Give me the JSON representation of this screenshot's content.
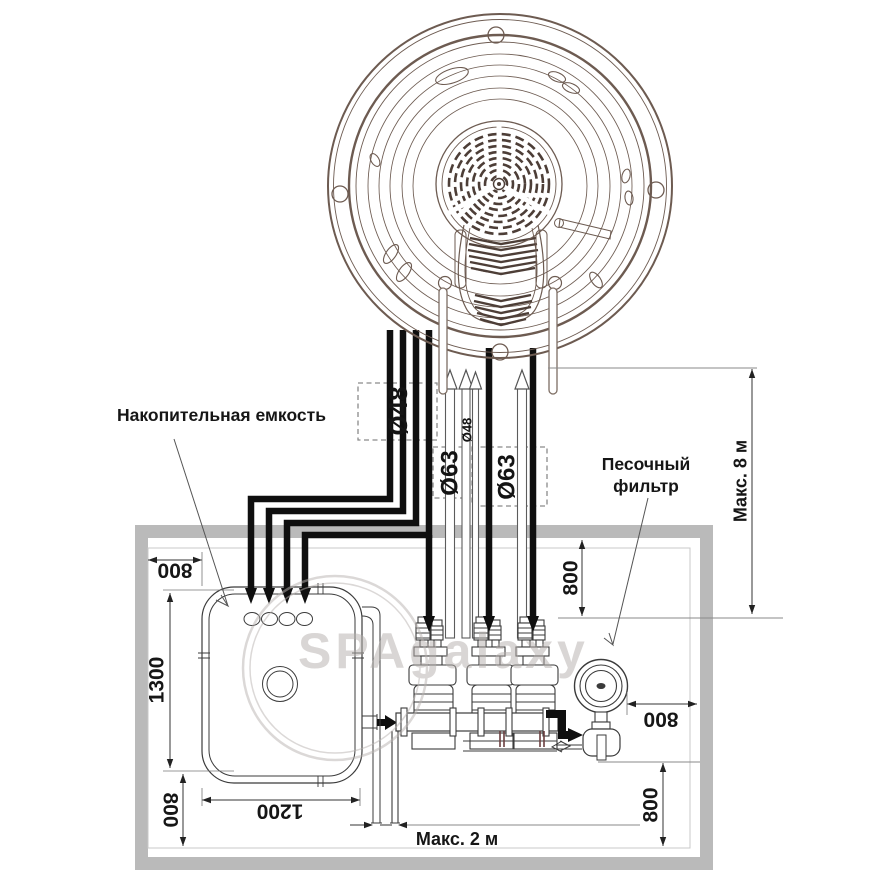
{
  "watermark": {
    "text": "SPAgalaxy"
  },
  "labels": {
    "storage_tank": "Накопительная емкость",
    "sand_filter_line1": "Песочный",
    "sand_filter_line2": "фильтр",
    "max_8m": "Макс. 8 м",
    "max_2m": "Макс. 2 м"
  },
  "pipes": {
    "d48_main": "Ø48",
    "d48_small": "Ø48",
    "d63_left": "Ø63",
    "d63_right": "Ø63"
  },
  "dims": {
    "wall_to_tank": "800",
    "tank_height": "1300",
    "tank_width": "1200",
    "tank_to_floor": "800",
    "ceiling_to_pump": "800",
    "filter_to_wall": "800",
    "filter_to_floor": "800"
  },
  "colors": {
    "wall_gray": "#bababa",
    "equipment_line": "#3b3b3b",
    "spa_line": "#6d5b51",
    "pipe_black": "#0f0f0f",
    "dimension": "#222222",
    "watermark_gray": "#b5afac"
  }
}
